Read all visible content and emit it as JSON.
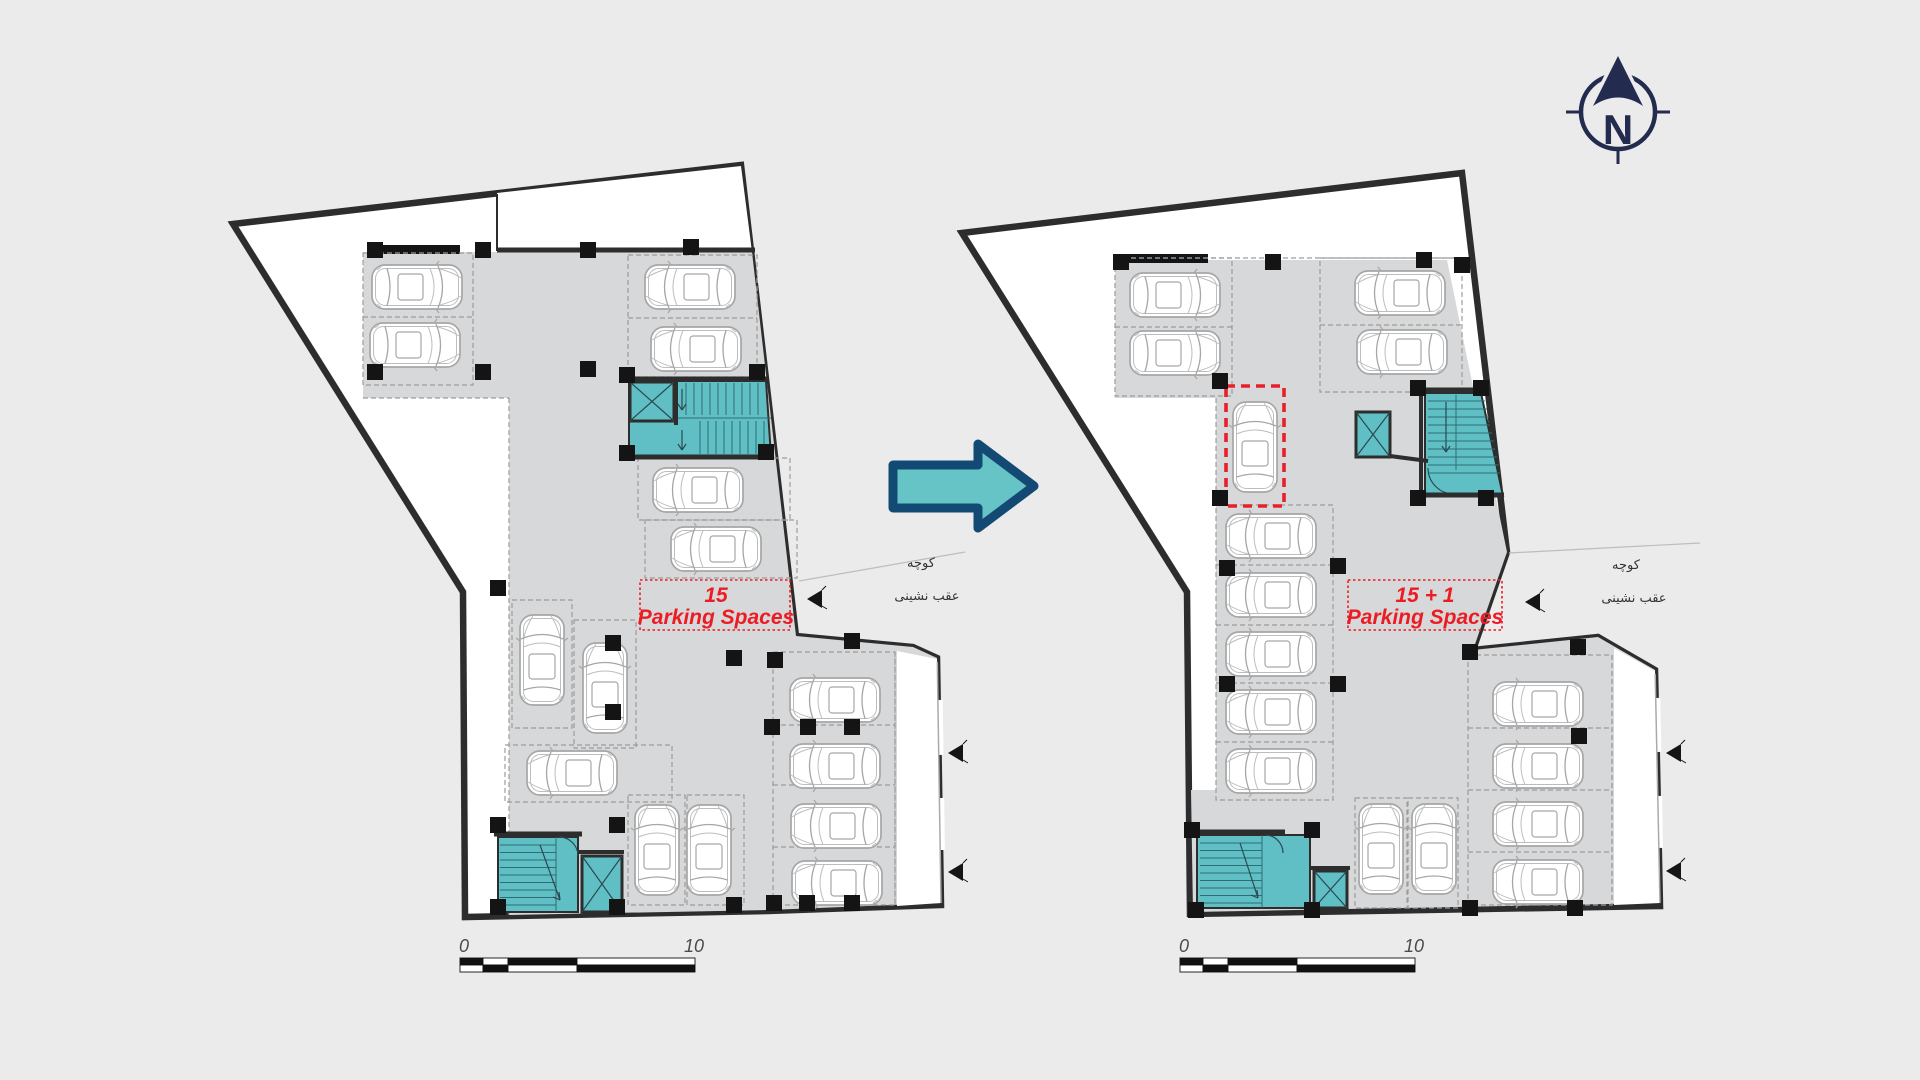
{
  "title": "Basement parking layout comparison — before and after",
  "compass": {
    "letter": "N",
    "color": "#232c4e"
  },
  "transition_arrow": {
    "direction": "right",
    "fill": "#66c4c6",
    "stroke": "#124a74"
  },
  "plans": {
    "before": {
      "count_label": "15",
      "caption": "Parking Spaces",
      "parking_spaces": 15,
      "street": "کوچه",
      "setback": "عقب نشینی",
      "scale_start": "0",
      "scale_end": "10"
    },
    "after": {
      "count_label": "15 + 1",
      "caption": "Parking Spaces",
      "parking_spaces": 16,
      "added_space_highlighted": true,
      "street": "کوچه",
      "setback": "عقب نشینی",
      "scale_start": "0",
      "scale_end": "10"
    }
  },
  "colors": {
    "background": "#ebebeb",
    "floor": "#d7d8d9",
    "wall": "#2d2d2d",
    "stair_core": "#60bfc4",
    "accent_red": "#ec1c24",
    "navy": "#232c4e"
  }
}
